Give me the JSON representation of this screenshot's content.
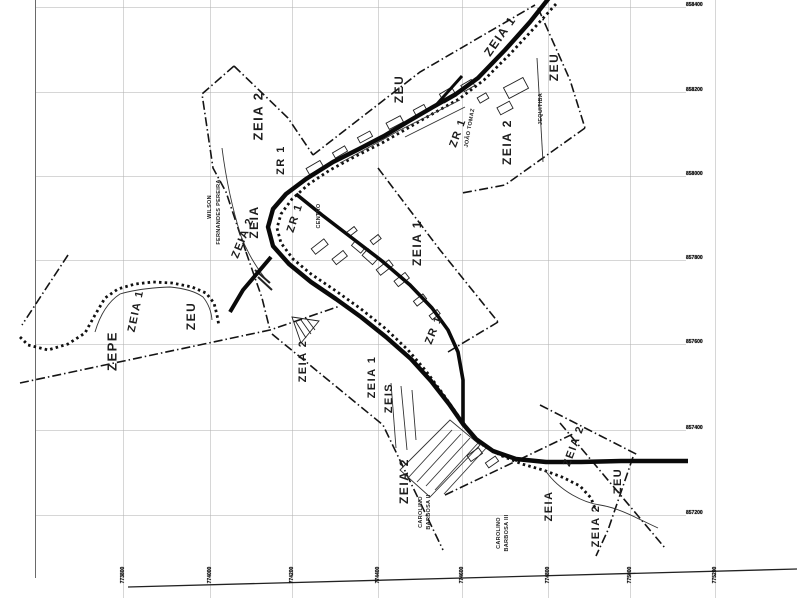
{
  "scan": {
    "background": "#ffffff",
    "ink": "#141414",
    "grid_color": "#b5b5b5",
    "frame_color": "#6a6a6a"
  },
  "map": {
    "zone_labels": [
      {
        "text": "ZEIA 2",
        "x": 258,
        "y": 116,
        "rot": -90,
        "size": 13
      },
      {
        "text": "ZR 1",
        "x": 281,
        "y": 160,
        "rot": -90,
        "size": 11
      },
      {
        "text": "ZEIA 2",
        "x": 243,
        "y": 238,
        "rot": -68,
        "size": 11
      },
      {
        "text": "ZEIA",
        "x": 254,
        "y": 222,
        "rot": -90,
        "size": 12
      },
      {
        "text": "ZR 1",
        "x": 295,
        "y": 218,
        "rot": -72,
        "size": 11
      },
      {
        "text": "ZEU",
        "x": 399,
        "y": 89,
        "rot": -90,
        "size": 12
      },
      {
        "text": "ZEIA 1",
        "x": 500,
        "y": 36,
        "rot": -55,
        "size": 12
      },
      {
        "text": "ZEU",
        "x": 554,
        "y": 67,
        "rot": -90,
        "size": 12
      },
      {
        "text": "ZEIA 2",
        "x": 507,
        "y": 142,
        "rot": -90,
        "size": 12
      },
      {
        "text": "ZR 1",
        "x": 458,
        "y": 133,
        "rot": -70,
        "size": 11
      },
      {
        "text": "ZEIA 1",
        "x": 417,
        "y": 243,
        "rot": -90,
        "size": 12
      },
      {
        "text": "ZEPE",
        "x": 112,
        "y": 351,
        "rot": -90,
        "size": 13
      },
      {
        "text": "ZEIA 1",
        "x": 136,
        "y": 311,
        "rot": -78,
        "size": 11
      },
      {
        "text": "ZEU",
        "x": 191,
        "y": 316,
        "rot": -90,
        "size": 12
      },
      {
        "text": "ZEIA 2",
        "x": 303,
        "y": 361,
        "rot": -90,
        "size": 11
      },
      {
        "text": "ZEIA 1",
        "x": 372,
        "y": 377,
        "rot": -90,
        "size": 11
      },
      {
        "text": "ZEIS",
        "x": 389,
        "y": 398,
        "rot": -90,
        "size": 11
      },
      {
        "text": "ZR 1",
        "x": 434,
        "y": 330,
        "rot": -68,
        "size": 11
      },
      {
        "text": "ZEIA 2",
        "x": 404,
        "y": 481,
        "rot": -90,
        "size": 12
      },
      {
        "text": "ZEIA",
        "x": 549,
        "y": 506,
        "rot": -90,
        "size": 11
      },
      {
        "text": "ZEIA 2",
        "x": 574,
        "y": 446,
        "rot": -70,
        "size": 11
      },
      {
        "text": "ZEU",
        "x": 618,
        "y": 481,
        "rot": -90,
        "size": 11
      },
      {
        "text": "ZEIA 2",
        "x": 596,
        "y": 526,
        "rot": -90,
        "size": 11
      }
    ],
    "street_labels": [
      {
        "text": "WILSON",
        "x": 210,
        "y": 207,
        "rot": -90
      },
      {
        "text": "FERNANDES PEREIRA",
        "x": 219,
        "y": 212,
        "rot": -90
      },
      {
        "text": "CENTRO",
        "x": 319,
        "y": 216,
        "rot": -90
      },
      {
        "text": "JOÃO TOMAZ",
        "x": 470,
        "y": 128,
        "rot": -80
      },
      {
        "text": "JEQUITIBA",
        "x": 541,
        "y": 109,
        "rot": -90
      },
      {
        "text": "CAROLINO",
        "x": 421,
        "y": 512,
        "rot": -90
      },
      {
        "text": "BARBOSA II",
        "x": 429,
        "y": 512,
        "rot": -90
      },
      {
        "text": "CAROLINO",
        "x": 499,
        "y": 533,
        "rot": -90
      },
      {
        "text": "BARBOSA III",
        "x": 507,
        "y": 533,
        "rot": -90
      }
    ],
    "axis": {
      "right_labels": [
        {
          "text": "858400",
          "y": 4
        },
        {
          "text": "858200",
          "y": 89
        },
        {
          "text": "858000",
          "y": 173
        },
        {
          "text": "857800",
          "y": 257
        },
        {
          "text": "857600",
          "y": 341
        },
        {
          "text": "857400",
          "y": 427
        },
        {
          "text": "857200",
          "y": 512
        }
      ],
      "bottom_labels": [
        {
          "text": "773800",
          "x": 123
        },
        {
          "text": "774000",
          "x": 210
        },
        {
          "text": "774200",
          "x": 292
        },
        {
          "text": "774400",
          "x": 378
        },
        {
          "text": "774600",
          "x": 462
        },
        {
          "text": "774800",
          "x": 548
        },
        {
          "text": "775000",
          "x": 630
        },
        {
          "text": "775200",
          "x": 715
        }
      ]
    }
  }
}
